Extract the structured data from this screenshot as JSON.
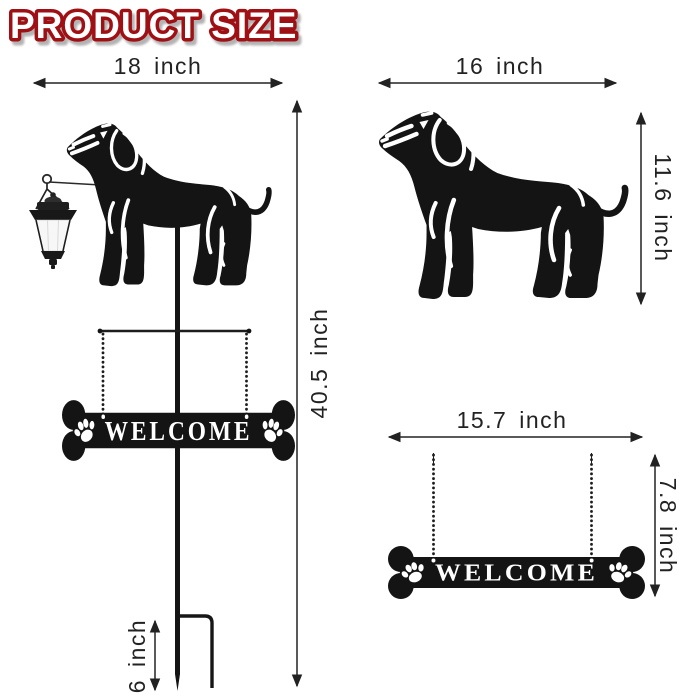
{
  "title": "PRODUCT SIZE",
  "sign": {
    "text": "WELCOME"
  },
  "dimensions": {
    "full_product": {
      "width": "18 inch",
      "height": "40.5 inch",
      "stake_depth": "6 inch"
    },
    "dog_cutout": {
      "width": "16 inch",
      "height": "11.6 inch"
    },
    "welcome_sign": {
      "width": "15.7 inch",
      "height": "7.8 inch"
    }
  },
  "colors": {
    "title_fill": "#ffffff",
    "title_outline": "#9e1014",
    "title_shadow": "#b3b3b3",
    "dimension_ink": "#222222",
    "silhouette": "#141414",
    "lantern_glass": "#f7f7f7",
    "background": "#ffffff"
  },
  "icons": {
    "dog": "dachshund-silhouette-icon",
    "lantern": "solar-lantern-icon",
    "paw": "paw-print-icon",
    "bone_sign": "bone-welcome-sign-icon",
    "stake": "garden-stake-icon",
    "chain": "hanging-chain-icon",
    "arrow": "dimension-arrow-icon"
  }
}
